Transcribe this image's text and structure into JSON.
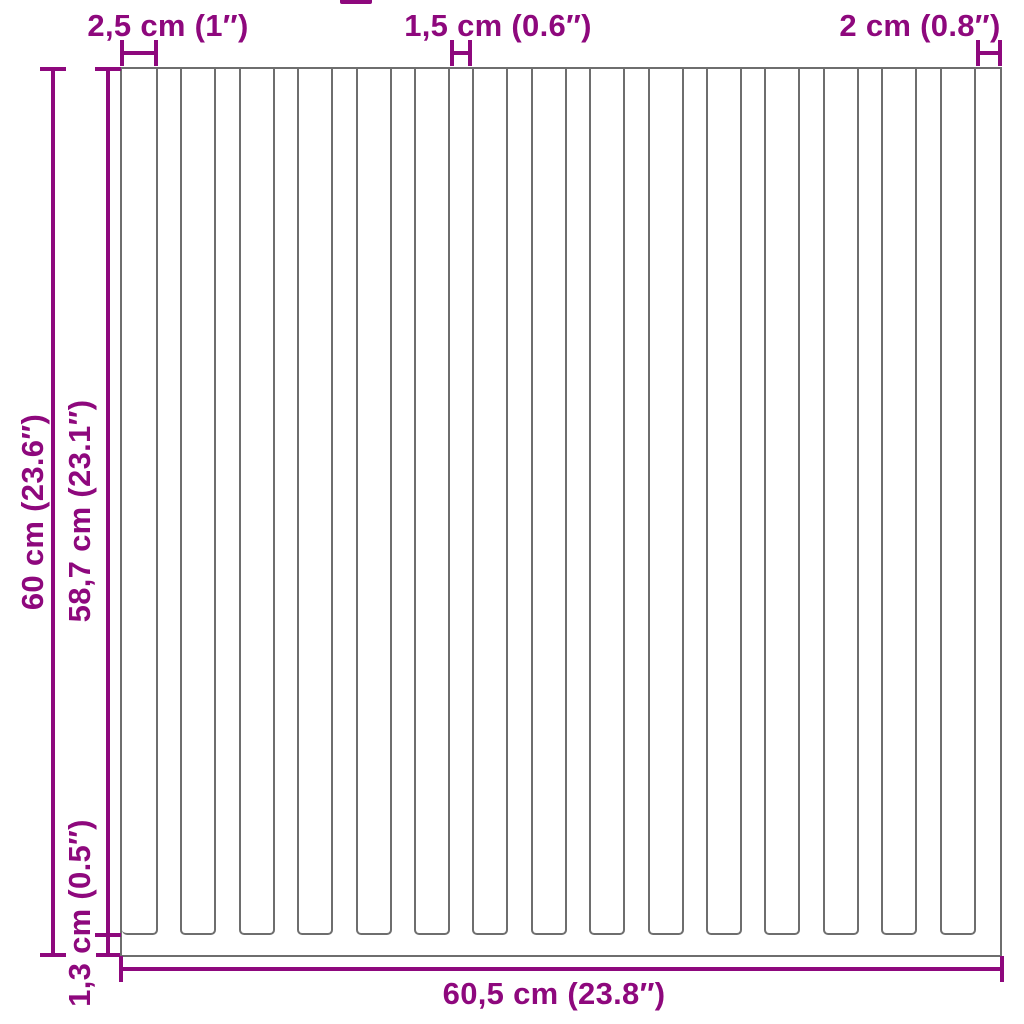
{
  "colors": {
    "dimension_purple": "#8E087D",
    "outline_gray": "#6E6E6E",
    "background": "#FFFFFF"
  },
  "panel": {
    "type": "vertical-slatted-panel",
    "slat_count": 15
  },
  "dimensions": {
    "slat_width": {
      "label": "2,5 cm (1″)"
    },
    "slat_gap": {
      "label": "1,5 cm (0.6″)"
    },
    "end_stile_width": {
      "label": "2 cm (0.8″)"
    },
    "total_height": {
      "label": "60 cm (23.6″)"
    },
    "slat_height": {
      "label": "58,7 cm (23.1″)"
    },
    "bottom_rail_height": {
      "label": "1,3 cm (0.5″)"
    },
    "total_width": {
      "label": "60,5 cm (23.8″)"
    }
  }
}
